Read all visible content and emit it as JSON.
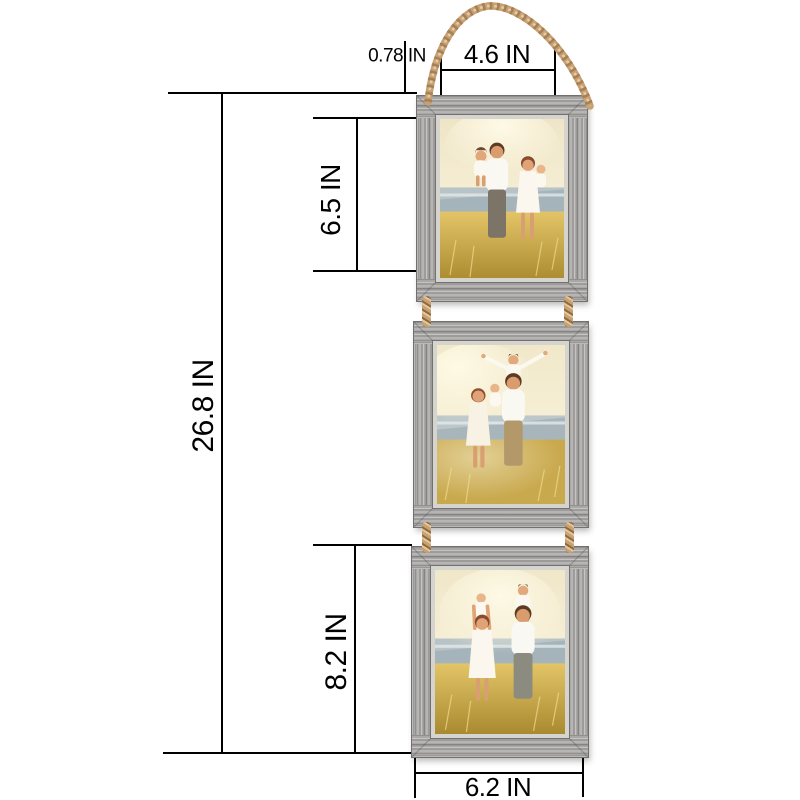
{
  "diagram": {
    "labels": {
      "border_width": "0.78 IN",
      "opening_width": "4.6 IN",
      "top_photo_height": "6.5 IN",
      "total_height": "26.8 IN",
      "bottom_frame_height": "8.2 IN",
      "frame_width": "6.2 IN"
    },
    "colors": {
      "background": "#ffffff",
      "dimension_line": "#000000",
      "frame_wood_gray": "#a9a8a6",
      "rope_tan": "#c7a173",
      "photo_sky_cream": "#f3ecd2",
      "photo_field_gold": "#c9a94e",
      "photo_water_gray": "#b8c3c7"
    },
    "frame_count": 3,
    "photos": [
      "family standing in sunlit field, father holding girl, mother holding baby",
      "family in sunlit field, child on father's shoulders with arms outstretched",
      "family in sunlit field, children riding on parents' shoulders"
    ]
  }
}
